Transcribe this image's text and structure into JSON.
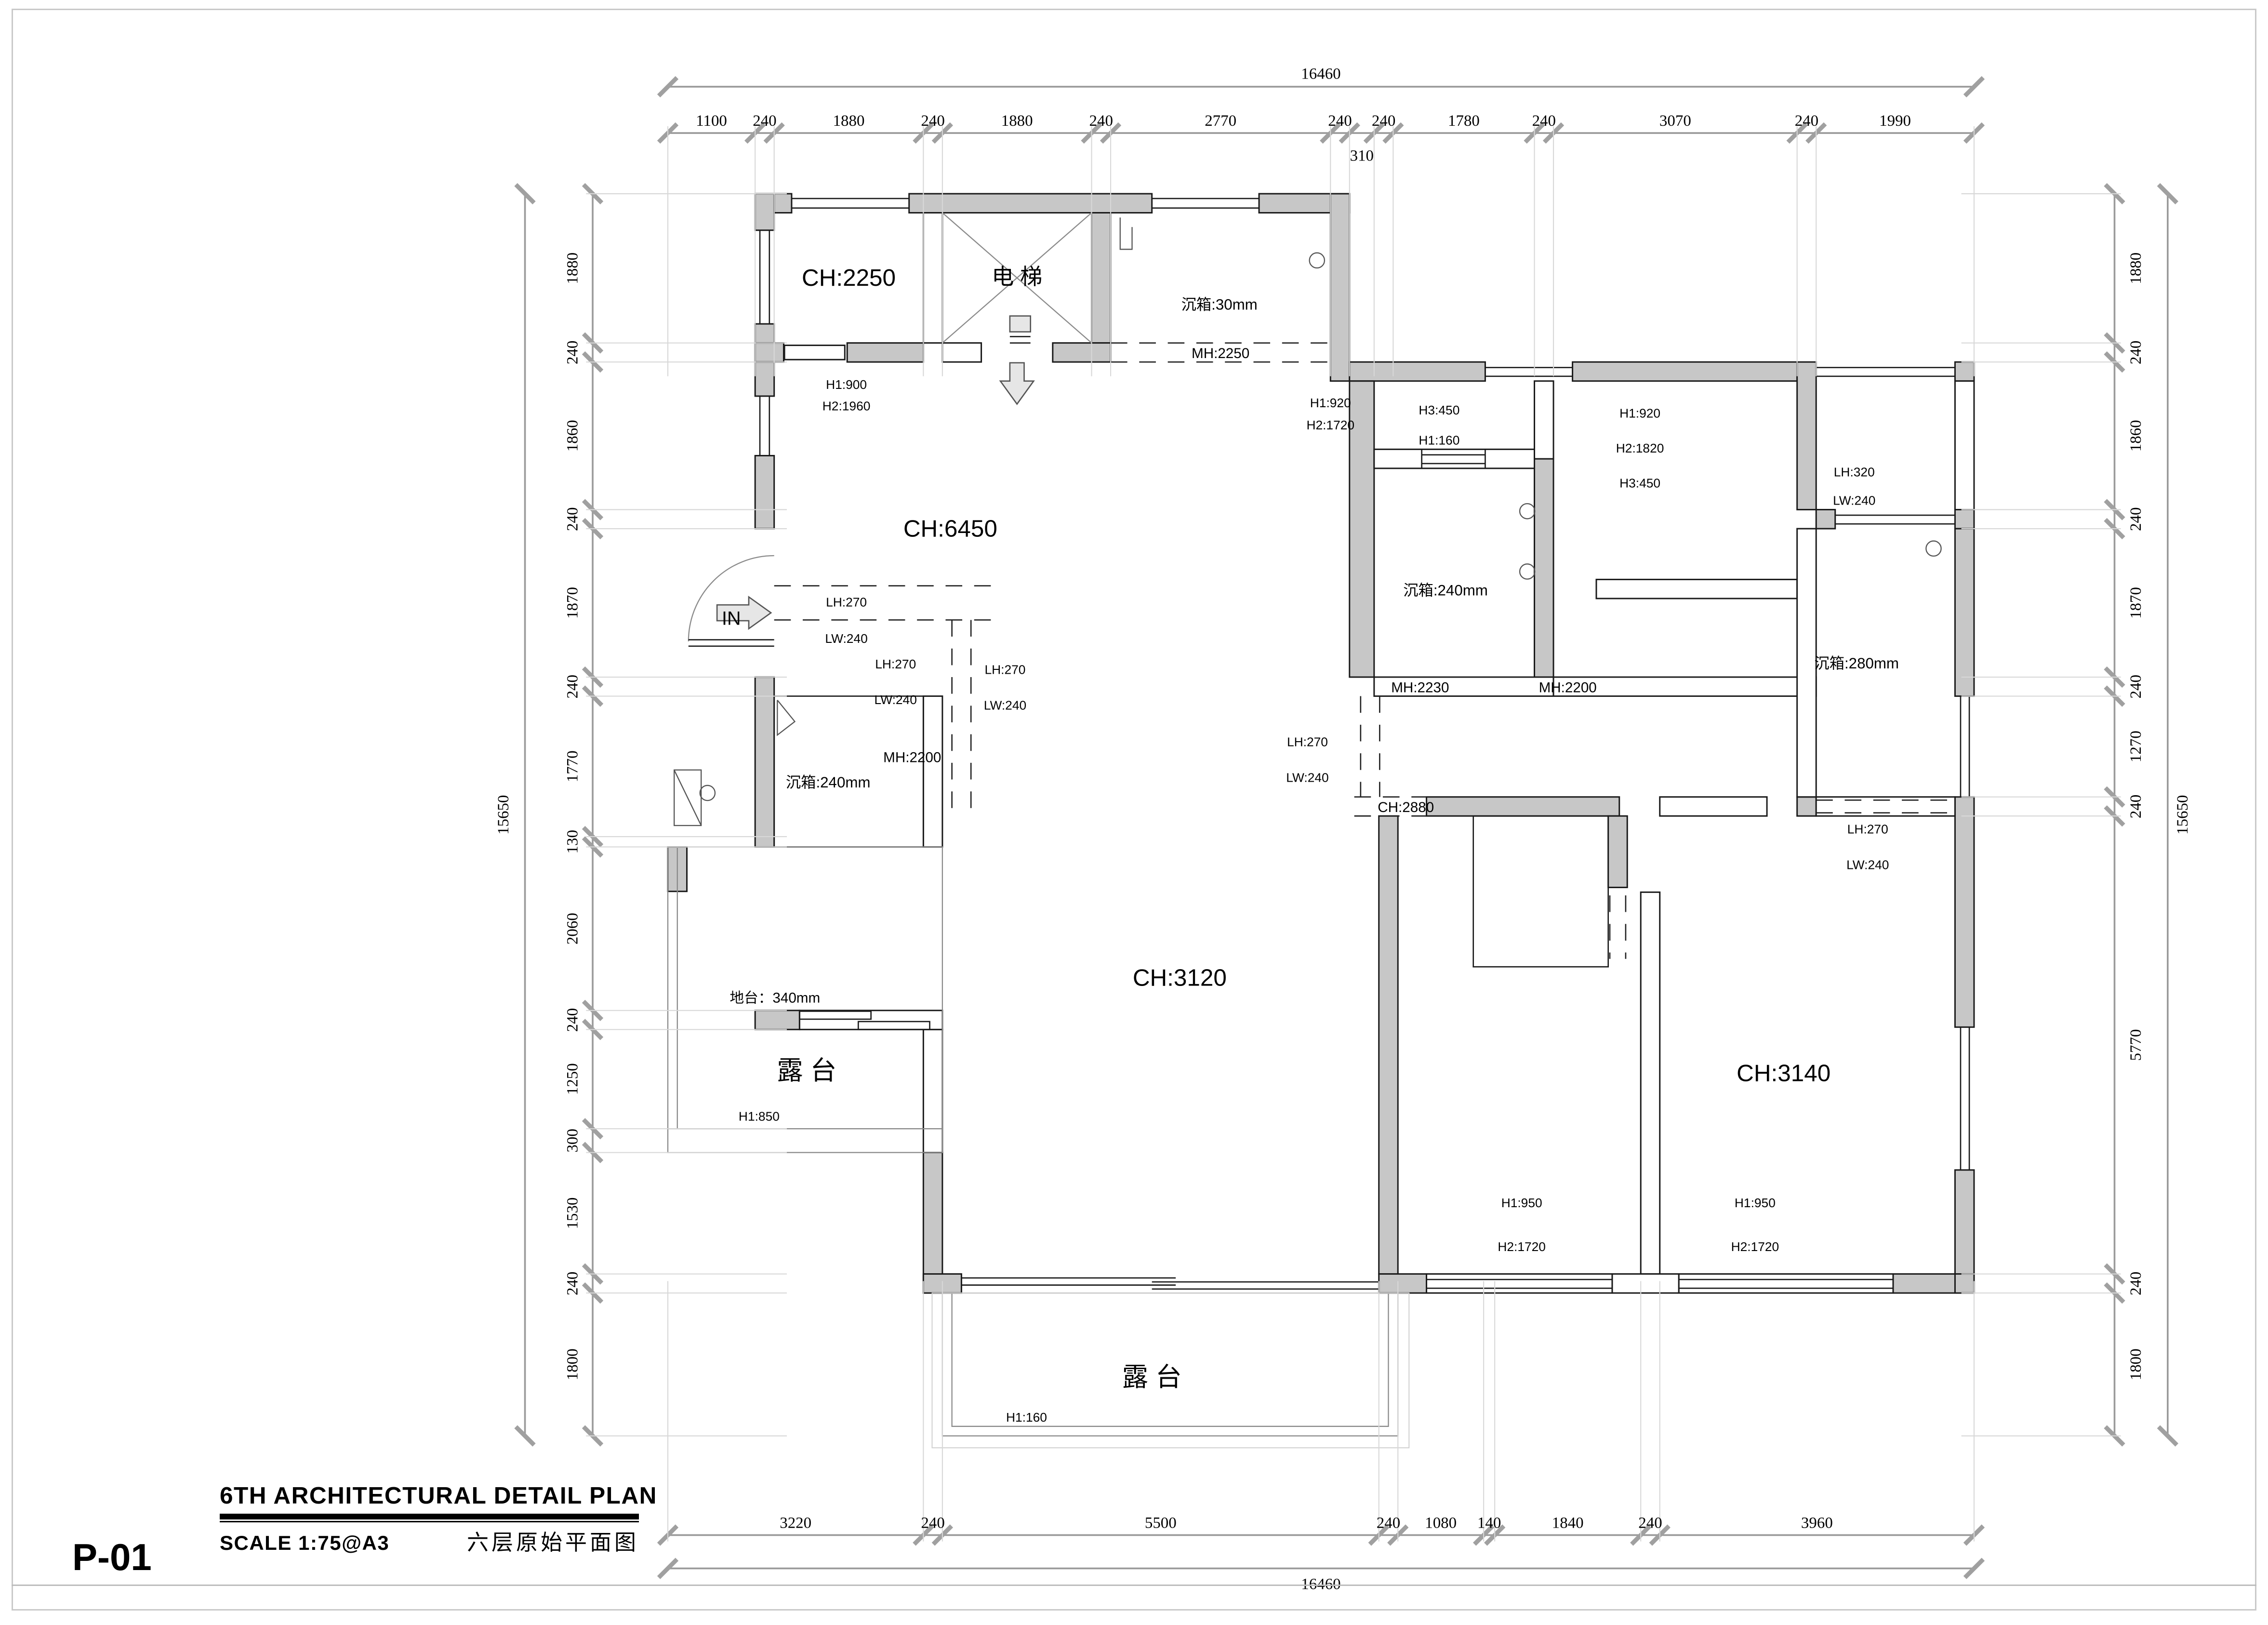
{
  "title_block": {
    "title": "6TH ARCHITECTURAL DETAIL PLAN",
    "scale": "SCALE 1:75@A3",
    "chinese_title": "六层原始平面图",
    "sheet_no": "P-01"
  },
  "dimensions": {
    "top": {
      "total": "16460",
      "segments": [
        "1100",
        "240",
        "1880",
        "240",
        "1880",
        "240",
        "2770",
        "240",
        "310",
        "240",
        "1780",
        "240",
        "3070",
        "240",
        "1990"
      ],
      "dropped_index": 8
    },
    "bottom": {
      "total": "16460",
      "segments": [
        "3220",
        "240",
        "5500",
        "240",
        "1080",
        "140",
        "1840",
        "240",
        "3960"
      ],
      "dropped_index": -1
    },
    "left": {
      "total": "15650",
      "segments": [
        "1880",
        "240",
        "1860",
        "240",
        "1870",
        "240",
        "1770",
        "130",
        "2060",
        "240",
        "1250",
        "300",
        "1530",
        "240",
        "1800"
      ],
      "dropped_index": -1
    },
    "right": {
      "total": "15650",
      "segments": [
        "1880",
        "240",
        "1860",
        "240",
        "1870",
        "240",
        "1270",
        "240",
        "5770",
        "240",
        "1800"
      ],
      "dropped_index": -1
    }
  },
  "labels": {
    "ch2250": "CH:2250",
    "elevator": "电 梯",
    "cj30": "沉箱:30mm",
    "mh2250": "MH:2250",
    "h1_900": "H1:900",
    "h2_1960": "H2:1960",
    "ch6450": "CH:6450",
    "in_label": "IN",
    "lh270_a": "LH:270",
    "lw240_b": "LW:240",
    "lh270_b": "LH:270",
    "lw240_c": "LW:240",
    "lh270_c": "LH:270",
    "lw240_d": "LW:240",
    "mh2200_l": "MH:2200",
    "cj240_l": "沉箱:240mm",
    "h1_920_a": "H1:920",
    "h2_1720_a": "H2:1720",
    "h3_450_a": "H3:450",
    "h1_160_a": "H1:160",
    "h1_920_b": "H1:920",
    "h2_1820": "H2:1820",
    "h3_450_b": "H3:450",
    "lh320": "LH:320",
    "lw240_a": "LW:240",
    "cj240_r": "沉箱:240mm",
    "mh2230": "MH:2230",
    "mh2200_r": "MH:2200",
    "cj280": "沉箱:280mm",
    "lh270_d": "LH:270",
    "lw240_e": "LW:240",
    "ch2880": "CH:2880",
    "lh270_e": "LH:270",
    "lw240_f": "LW:240",
    "ch3120": "CH:3120",
    "ch3140": "CH:3140",
    "ditai": "地台：340mm",
    "lutai_left": "露 台",
    "h1_850": "H1:850",
    "lutai_bottom": "露 台",
    "h1_160_b": "H1:160",
    "h1_950_a": "H1:950",
    "h2_1720_b": "H2:1720",
    "h1_950_b": "H1:950",
    "h2_1720_c": "H2:1720"
  },
  "colors": {
    "wall_fill": "#c7c7c7",
    "line": "#1a1a1a",
    "dim_tick": "#a0a0a0",
    "extension_line": "#d8d8d8",
    "terrace_line": "#8a8a8a"
  }
}
